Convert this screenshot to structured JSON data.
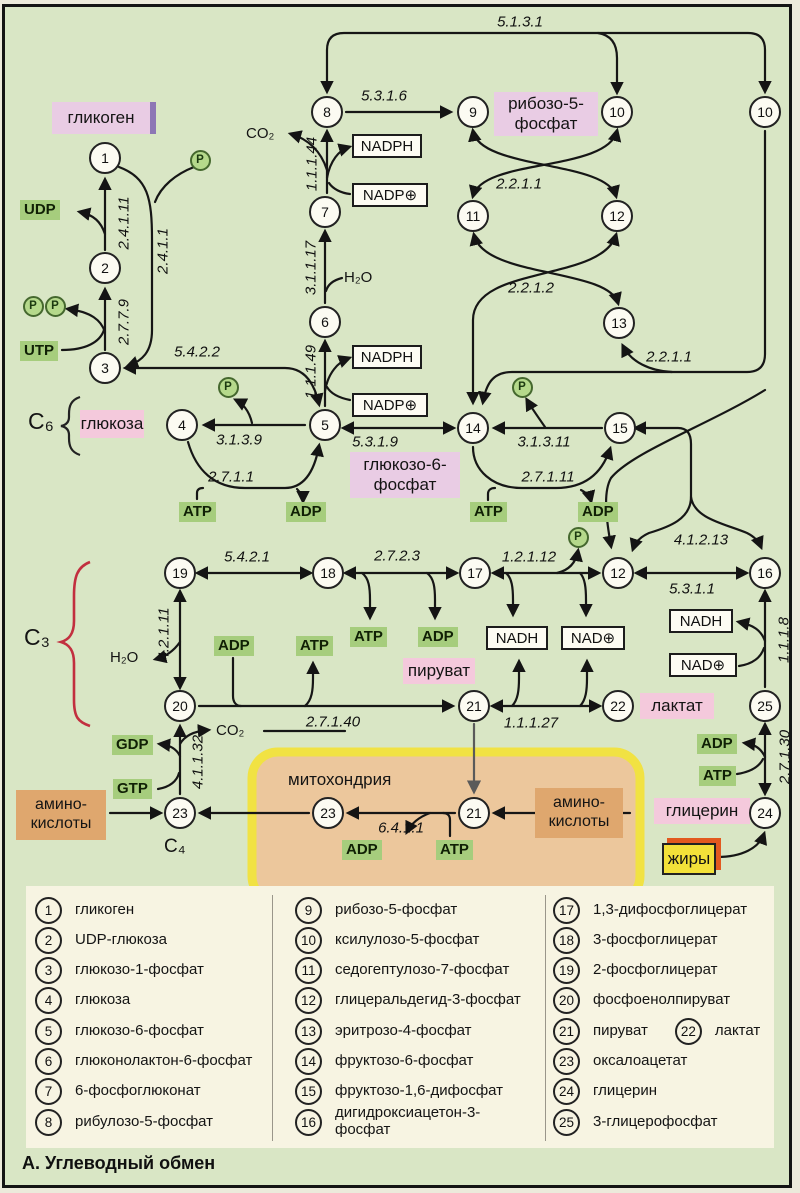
{
  "title": "А. Углеводный обмен",
  "colors": {
    "bg": "#d9e6c5",
    "panel": "#f7f4e2",
    "pink": "#f4c9dc",
    "lavender": "#e9cce4",
    "orange": "#dfa76e",
    "greenlab": "#a6cd7d",
    "fatyellow": "#f3e139",
    "fatshadow": "#e2591f",
    "glybar": "#8d77b5",
    "mito_fill": "#ecc79c",
    "mito_border": "#f1e243",
    "brace_red": "#c22f3f",
    "arrow": "#161616"
  },
  "diagram": {
    "circles": [
      {
        "n": "1",
        "x": 105,
        "y": 158
      },
      {
        "n": "2",
        "x": 105,
        "y": 268
      },
      {
        "n": "3",
        "x": 105,
        "y": 368
      },
      {
        "n": "4",
        "x": 182,
        "y": 425
      },
      {
        "n": "5",
        "x": 325,
        "y": 425
      },
      {
        "n": "6",
        "x": 325,
        "y": 322
      },
      {
        "n": "7",
        "x": 325,
        "y": 212
      },
      {
        "n": "8",
        "x": 327,
        "y": 112
      },
      {
        "n": "9",
        "x": 473,
        "y": 112
      },
      {
        "n": "10",
        "x": 617,
        "y": 112
      },
      {
        "n": "10",
        "x": 765,
        "y": 112
      },
      {
        "n": "11",
        "x": 473,
        "y": 216
      },
      {
        "n": "12",
        "x": 617,
        "y": 216
      },
      {
        "n": "13",
        "x": 619,
        "y": 323
      },
      {
        "n": "14",
        "x": 473,
        "y": 428
      },
      {
        "n": "15",
        "x": 620,
        "y": 428
      },
      {
        "n": "19",
        "x": 180,
        "y": 573
      },
      {
        "n": "18",
        "x": 328,
        "y": 573
      },
      {
        "n": "17",
        "x": 475,
        "y": 573
      },
      {
        "n": "12",
        "x": 618,
        "y": 573
      },
      {
        "n": "16",
        "x": 765,
        "y": 573
      },
      {
        "n": "20",
        "x": 180,
        "y": 706
      },
      {
        "n": "21",
        "x": 474,
        "y": 706
      },
      {
        "n": "22",
        "x": 618,
        "y": 706
      },
      {
        "n": "25",
        "x": 765,
        "y": 706
      },
      {
        "n": "23",
        "x": 180,
        "y": 813
      },
      {
        "n": "23",
        "x": 328,
        "y": 813
      },
      {
        "n": "21",
        "x": 474,
        "y": 813
      },
      {
        "n": "24",
        "x": 765,
        "y": 813
      }
    ],
    "ec_labels": [
      {
        "t": "5.1.3.1",
        "x": 520,
        "y": 22
      },
      {
        "t": "5.3.1.6",
        "x": 384,
        "y": 96
      },
      {
        "t": "2.2.1.1",
        "x": 519,
        "y": 184
      },
      {
        "t": "2.2.1.2",
        "x": 531,
        "y": 288
      },
      {
        "t": "2.2.1.1",
        "x": 669,
        "y": 357
      },
      {
        "t": "5.4.2.2",
        "x": 197,
        "y": 352
      },
      {
        "t": "3.1.3.9",
        "x": 239,
        "y": 440
      },
      {
        "t": "5.3.1.9",
        "x": 375,
        "y": 442
      },
      {
        "t": "3.1.3.11",
        "x": 544,
        "y": 442
      },
      {
        "t": "2.7.1.1",
        "x": 231,
        "y": 477
      },
      {
        "t": "2.7.1.11",
        "x": 548,
        "y": 477
      },
      {
        "t": "4.1.2.13",
        "x": 701,
        "y": 540
      },
      {
        "t": "5.4.2.1",
        "x": 247,
        "y": 557
      },
      {
        "t": "2.7.2.3",
        "x": 397,
        "y": 556
      },
      {
        "t": "1.2.1.12",
        "x": 529,
        "y": 557
      },
      {
        "t": "5.3.1.1",
        "x": 692,
        "y": 589
      },
      {
        "t": "2.7.1.40",
        "x": 333,
        "y": 722
      },
      {
        "t": "1.1.1.27",
        "x": 531,
        "y": 723
      },
      {
        "t": "6.4.1.1",
        "x": 401,
        "y": 828
      },
      {
        "t": "2.4.1.11",
        "x": 124,
        "y": 223,
        "rot": true
      },
      {
        "t": "2.4.1.1",
        "x": 163,
        "y": 251,
        "rot": true
      },
      {
        "t": "2.7.7.9",
        "x": 124,
        "y": 322,
        "rot": true
      },
      {
        "t": "1.1.1.44",
        "x": 312,
        "y": 164,
        "rot": true
      },
      {
        "t": "3.1.1.17",
        "x": 311,
        "y": 268,
        "rot": true
      },
      {
        "t": "1.1.1.49",
        "x": 311,
        "y": 372,
        "rot": true
      },
      {
        "t": "4.2.1.11",
        "x": 164,
        "y": 634,
        "rot": true
      },
      {
        "t": "4.1.1.32",
        "x": 198,
        "y": 762,
        "rot": true
      },
      {
        "t": "1.1.1.8",
        "x": 784,
        "y": 640,
        "rot": true
      },
      {
        "t": "2.7.1.30",
        "x": 785,
        "y": 757,
        "rot": true
      }
    ],
    "metabolite_boxes": [
      {
        "lines": [
          "гликоген"
        ],
        "x": 52,
        "y": 102,
        "w": 104,
        "h": 32,
        "style": "lavender",
        "bar": true
      },
      {
        "lines": [
          "глюкоза"
        ],
        "x": 80,
        "y": 410,
        "w": 64,
        "h": 28,
        "style": "pink"
      },
      {
        "lines": [
          "глюкозо-6-",
          "фосфат"
        ],
        "x": 350,
        "y": 452,
        "w": 110,
        "h": 46,
        "style": "lavender"
      },
      {
        "lines": [
          "рибозо-5-",
          "фосфат"
        ],
        "x": 494,
        "y": 92,
        "w": 104,
        "h": 44,
        "style": "lavender"
      },
      {
        "lines": [
          "пируват"
        ],
        "x": 403,
        "y": 658,
        "w": 72,
        "h": 26,
        "style": "pink"
      },
      {
        "lines": [
          "лактат"
        ],
        "x": 640,
        "y": 693,
        "w": 74,
        "h": 26,
        "style": "pink"
      },
      {
        "lines": [
          "глицерин"
        ],
        "x": 654,
        "y": 798,
        "w": 96,
        "h": 26,
        "style": "pink"
      },
      {
        "lines": [
          "амино-",
          "кислоты"
        ],
        "x": 16,
        "y": 790,
        "w": 90,
        "h": 50,
        "style": "orange"
      },
      {
        "lines": [
          "амино-",
          "кислоты"
        ],
        "x": 535,
        "y": 788,
        "w": 88,
        "h": 50,
        "style": "orange"
      },
      {
        "lines": [
          "жиры"
        ],
        "x": 662,
        "y": 843,
        "w": 54,
        "h": 32,
        "style": "fat"
      }
    ],
    "cofactors": [
      {
        "t": "UDP",
        "x": 20,
        "y": 200
      },
      {
        "t": "UTP",
        "x": 20,
        "y": 341
      },
      {
        "t": "ATP",
        "x": 179,
        "y": 502
      },
      {
        "t": "ADP",
        "x": 286,
        "y": 502
      },
      {
        "t": "ATP",
        "x": 470,
        "y": 502
      },
      {
        "t": "ADP",
        "x": 578,
        "y": 502
      },
      {
        "t": "ATP",
        "x": 350,
        "y": 627
      },
      {
        "t": "ADP",
        "x": 418,
        "y": 627
      },
      {
        "t": "ADP",
        "x": 214,
        "y": 636
      },
      {
        "t": "ATP",
        "x": 296,
        "y": 636
      },
      {
        "t": "GDP",
        "x": 112,
        "y": 735
      },
      {
        "t": "GTP",
        "x": 113,
        "y": 779
      },
      {
        "t": "ADP",
        "x": 342,
        "y": 840
      },
      {
        "t": "ATP",
        "x": 436,
        "y": 840
      },
      {
        "t": "ADP",
        "x": 697,
        "y": 734
      },
      {
        "t": "ATP",
        "x": 699,
        "y": 766
      }
    ],
    "nad_boxes": [
      {
        "t": "NADPH",
        "x": 352,
        "y": 134,
        "w": 70
      },
      {
        "t": "NADP⊕",
        "x": 352,
        "y": 183,
        "w": 76
      },
      {
        "t": "NADPH",
        "x": 352,
        "y": 345,
        "w": 70
      },
      {
        "t": "NADP⊕",
        "x": 352,
        "y": 393,
        "w": 76
      },
      {
        "t": "NADH",
        "x": 486,
        "y": 626,
        "w": 62
      },
      {
        "t": "NAD⊕",
        "x": 561,
        "y": 626,
        "w": 64
      },
      {
        "t": "NADH",
        "x": 669,
        "y": 609,
        "w": 64
      },
      {
        "t": "NAD⊕",
        "x": 669,
        "y": 653,
        "w": 68
      }
    ],
    "p_markers": [
      {
        "x": 200,
        "y": 160
      },
      {
        "x": 33,
        "y": 306
      },
      {
        "x": 55,
        "y": 306
      },
      {
        "x": 228,
        "y": 387
      },
      {
        "x": 522,
        "y": 387
      },
      {
        "x": 578,
        "y": 537
      }
    ],
    "p_letter": "P",
    "plain_texts": [
      {
        "t": "митохондрия",
        "x": 288,
        "y": 770,
        "size": 17
      },
      {
        "t": "CO₂",
        "x": 246,
        "y": 125,
        "size": 15
      },
      {
        "t": "CO₂",
        "x": 216,
        "y": 722,
        "size": 15
      },
      {
        "t": "H₂O",
        "x": 344,
        "y": 269,
        "size": 15
      },
      {
        "t": "H₂O",
        "x": 110,
        "y": 649,
        "size": 15
      },
      {
        "t": "C₆",
        "x": 28,
        "y": 408,
        "size": 23
      },
      {
        "t": "C₃",
        "x": 24,
        "y": 624,
        "size": 23
      },
      {
        "t": "C₄",
        "x": 164,
        "y": 836,
        "size": 19
      }
    ]
  },
  "legend": {
    "row_start": 896,
    "row_step": 30.3,
    "dividers": [
      272,
      545
    ],
    "columns": [
      {
        "x": 35,
        "entries": [
          {
            "n": "1",
            "label": "гликоген"
          },
          {
            "n": "2",
            "label": "UDP-глюкоза"
          },
          {
            "n": "3",
            "label": "глюкозо-1-фосфат"
          },
          {
            "n": "4",
            "label": "глюкоза"
          },
          {
            "n": "5",
            "label": "глюкозо-6-фосфат"
          },
          {
            "n": "6",
            "label": "глюконолактон-6-фосфат"
          },
          {
            "n": "7",
            "label": "6-фосфоглюконат"
          },
          {
            "n": "8",
            "label": "рибулозо-5-фосфат"
          }
        ]
      },
      {
        "x": 295,
        "entries": [
          {
            "n": "9",
            "label": "рибозо-5-фосфат"
          },
          {
            "n": "10",
            "label": "ксилулозо-5-фосфат"
          },
          {
            "n": "11",
            "label": "седогептулозо-7-фосфат"
          },
          {
            "n": "12",
            "label": "глицеральдегид-3-фосфат"
          },
          {
            "n": "13",
            "label": "эритрозо-4-фосфат"
          },
          {
            "n": "14",
            "label": "фруктозо-6-фосфат"
          },
          {
            "n": "15",
            "label": "фруктозо-1,6-дифосфат"
          },
          {
            "n": "16",
            "label": "дигидроксиацетон-3-\nфосфат"
          }
        ]
      },
      {
        "x": 553,
        "entries": [
          {
            "n": "17",
            "label": "1,3-дифосфоглицерат"
          },
          {
            "n": "18",
            "label": "3-фосфоглицерат"
          },
          {
            "n": "19",
            "label": "2-фосфоглицерат"
          },
          {
            "n": "20",
            "label": "фосфоенолпируват"
          },
          {
            "n": "21",
            "label": "пируват",
            "n2": "22",
            "label2": "лактат"
          },
          {
            "n": "23",
            "label": "оксалоацетат"
          },
          {
            "n": "24",
            "label": "глицерин"
          },
          {
            "n": "25",
            "label": "3-глицерофосфат"
          }
        ]
      }
    ]
  }
}
